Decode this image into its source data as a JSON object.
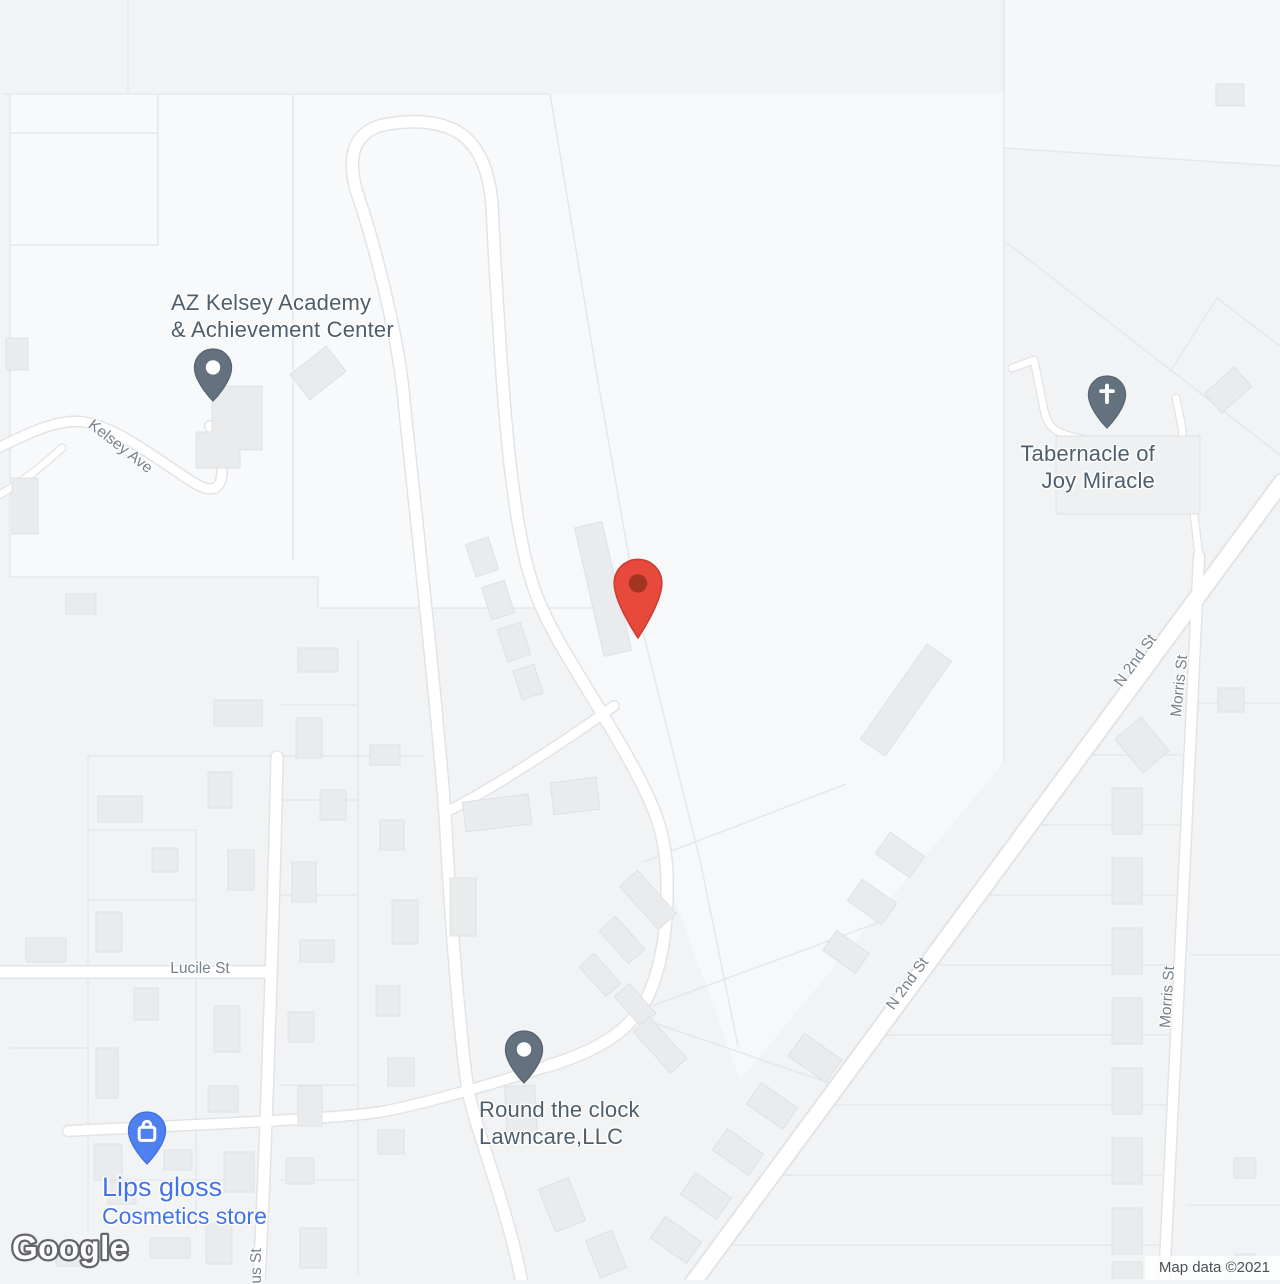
{
  "map": {
    "logo_text": "Google",
    "attribution": "Map data ©2021",
    "theme": {
      "background": "#f2f3f4",
      "parcel_light": "#f8f9fa",
      "road_fill": "#ffffff",
      "road_casing": "#e1e4e7",
      "parcel_line": "#e5e7ea",
      "building_fill": "#e9ebed",
      "building_stroke": "#dee1e4",
      "poi_label_color": "#4e5e6c",
      "street_label_color": "#76818c",
      "store_label_color": "#4273e8",
      "poi_pin_color": "#64717e",
      "store_pin_color": "#4e80f0",
      "marker_red": "#e7493c",
      "marker_red_center": "#a33424"
    },
    "pois": [
      {
        "name": "AZ Kelsey Academy & Achievement Center",
        "lines": [
          "AZ Kelsey Academy",
          "& Achievement Center"
        ],
        "icon": "generic-poi-pin"
      },
      {
        "name": "Tabernacle of Joy Miracle",
        "lines": [
          "Tabernacle of",
          "Joy Miracle"
        ],
        "icon": "church-pin"
      },
      {
        "name": "Round the clock Lawncare,LLC",
        "lines": [
          "Round the clock",
          "Lawncare,LLC"
        ],
        "icon": "generic-poi-pin"
      },
      {
        "name": "Lips gloss",
        "lines": [
          "Lips gloss",
          "Cosmetics store"
        ],
        "icon": "shopping-bag-pin"
      },
      {
        "name": "destination-marker",
        "lines": [],
        "icon": "red-marker"
      }
    ],
    "street_labels": [
      {
        "name": "Kelsey Ave"
      },
      {
        "name": "Lucile St"
      },
      {
        "name": "N 2nd St"
      },
      {
        "name": "Morris St"
      },
      {
        "name": "N 2nd St"
      },
      {
        "name": "Morris St"
      },
      {
        "name": "us St"
      }
    ]
  }
}
